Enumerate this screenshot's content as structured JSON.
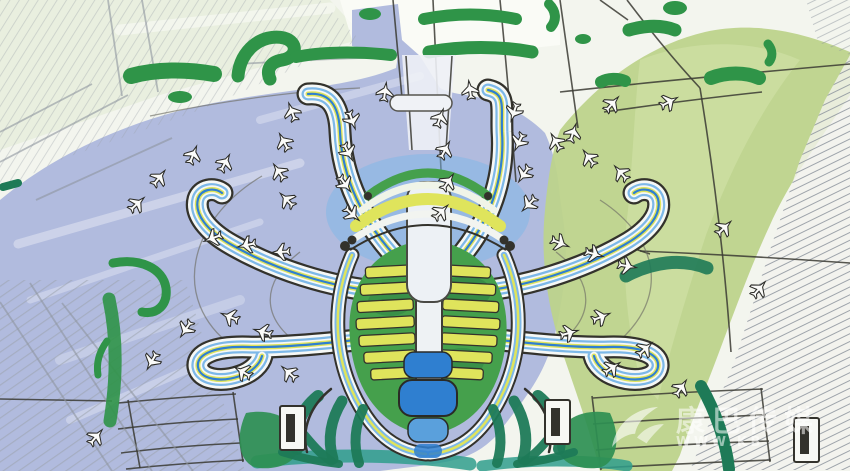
{
  "meta": {
    "subject": "Hand-drawn marker concept sketch: aerial master plan of a starfish-shaped airport terminal",
    "medium": "marker, ink and pencil on paper",
    "terminal_piers": 6
  },
  "watermark": {
    "site_name": "康巴传媒",
    "url_visible": "WWW.KB",
    "logo": "swoosh-bird-logo"
  },
  "palette": {
    "paper": "#f3f5ee",
    "apron": "#adb7dc",
    "field": "#bdd38b",
    "field_soft": "#d3e4ab",
    "marker_green": "#2f9448",
    "dark_green": "#2e8f52",
    "teal": "#1e7a57",
    "aqua": "#2f9d8c",
    "terminal_blue": "#2f7fd0",
    "sky_blue": "#7db8e8",
    "rib_yellow": "#dfe45c",
    "body_green": "#45a04c",
    "ink": "#33322c",
    "pencil": "#8d949e"
  },
  "scene": {
    "aircraft": [
      [
        292,
        112,
        -20
      ],
      [
        284,
        142,
        -28
      ],
      [
        279,
        172,
        -34
      ],
      [
        287,
        200,
        -45
      ],
      [
        352,
        120,
        160
      ],
      [
        348,
        152,
        152
      ],
      [
        345,
        184,
        144
      ],
      [
        352,
        214,
        132
      ],
      [
        440,
        118,
        20
      ],
      [
        445,
        150,
        28
      ],
      [
        448,
        182,
        34
      ],
      [
        441,
        212,
        45
      ],
      [
        514,
        112,
        198
      ],
      [
        519,
        142,
        206
      ],
      [
        524,
        174,
        214
      ],
      [
        529,
        204,
        224
      ],
      [
        385,
        92,
        8
      ],
      [
        470,
        90,
        -8
      ],
      [
        225,
        163,
        28
      ],
      [
        193,
        155,
        22
      ],
      [
        159,
        178,
        38
      ],
      [
        137,
        204,
        48
      ],
      [
        213,
        238,
        250
      ],
      [
        247,
        245,
        258
      ],
      [
        281,
        252,
        266
      ],
      [
        230,
        317,
        292
      ],
      [
        263,
        332,
        286
      ],
      [
        152,
        361,
        210
      ],
      [
        186,
        329,
        214
      ],
      [
        243,
        372,
        300
      ],
      [
        289,
        373,
        312
      ],
      [
        96,
        437,
        40
      ],
      [
        556,
        142,
        -30
      ],
      [
        589,
        158,
        -36
      ],
      [
        621,
        173,
        -42
      ],
      [
        560,
        243,
        112
      ],
      [
        594,
        254,
        106
      ],
      [
        627,
        266,
        100
      ],
      [
        601,
        317,
        68
      ],
      [
        569,
        333,
        74
      ],
      [
        612,
        368,
        56
      ],
      [
        645,
        349,
        48
      ],
      [
        612,
        104,
        42
      ],
      [
        669,
        102,
        62
      ],
      [
        724,
        228,
        46
      ],
      [
        759,
        289,
        40
      ],
      [
        681,
        388,
        34
      ],
      [
        573,
        133,
        18
      ]
    ],
    "buildings": [
      [
        280,
        406
      ],
      [
        545,
        400
      ],
      [
        794,
        418
      ]
    ]
  }
}
